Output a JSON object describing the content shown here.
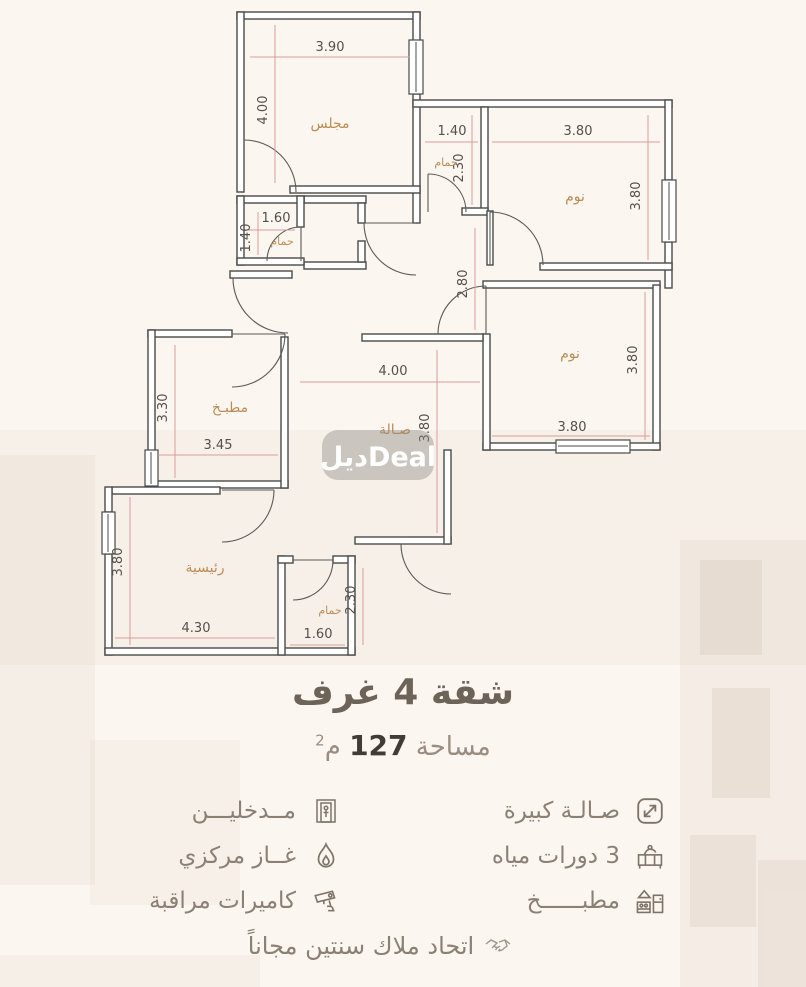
{
  "title": "شقة 4 غرف",
  "area": {
    "prefix": "مساحة",
    "value": "127",
    "unit": "م",
    "sup": "2"
  },
  "watermark": {
    "text": "ديلDeal"
  },
  "floor_plan": {
    "hall_width": "2.80",
    "rooms": [
      {
        "name": "مجلس",
        "width": "3.90",
        "height": "4.00"
      },
      {
        "name": "حمام",
        "width": "1.40",
        "height": "2.30"
      },
      {
        "name": "نوم",
        "width": "3.80",
        "height": "3.80"
      },
      {
        "name": "حمام",
        "width": "1.60",
        "height": "1.40"
      },
      {
        "name": "نوم",
        "width": "3.80",
        "height": "3.80"
      },
      {
        "name": "مطبـخ",
        "width": "3.45",
        "height": "3.30"
      },
      {
        "name": "صـالة",
        "width": "4.00",
        "height": "3.80"
      },
      {
        "name": "رئيسية",
        "width": "4.30",
        "height": "3.80"
      },
      {
        "name": "حمام",
        "width": "1.60",
        "height": "2.30"
      }
    ]
  },
  "features": {
    "right": [
      {
        "icon": "expand-icon",
        "label": "صـالـة كبيرة"
      },
      {
        "icon": "sink-icon",
        "label": "3 دورات مياه"
      },
      {
        "icon": "kitchen-icon",
        "label": "مطبــــــخ"
      }
    ],
    "left": [
      {
        "icon": "entrance-icon",
        "label": "مــدخليـــن"
      },
      {
        "icon": "gas-icon",
        "label": "غــاز مركزي"
      },
      {
        "icon": "camera-icon",
        "label": "كاميرات مراقبة"
      }
    ]
  },
  "footnote": "اتحاد ملاك سنتين مجاناً",
  "colors": {
    "background": "#fcf6f0",
    "wall": "#4a4a48",
    "dimension_line": "#d89c9c",
    "dimension_text": "#54504c",
    "room_label": "#bb8d55",
    "title": "#6d6459",
    "subtitle": "#9a8e82",
    "feature_text": "#8b8074",
    "icon": "#7d7468",
    "watermark_text": "#ffffff"
  }
}
